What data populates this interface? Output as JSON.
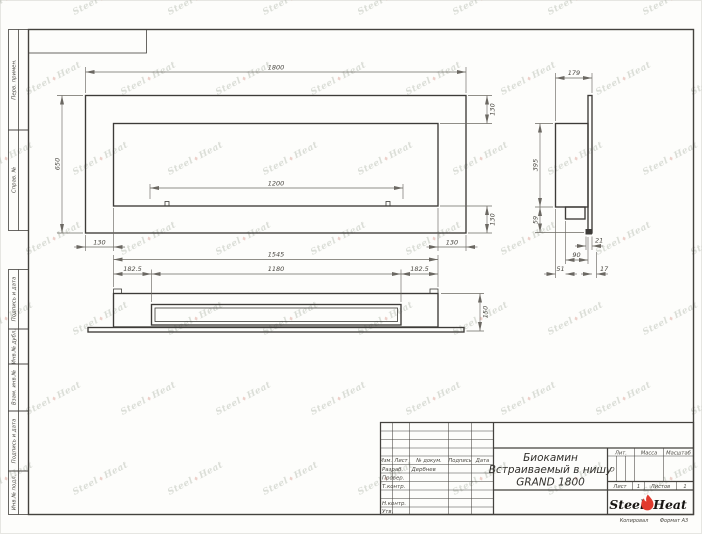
{
  "watermark": {
    "left": "Steel",
    "right": "Heat",
    "flame": "♦"
  },
  "margin_labels": [
    "Перв. примен.",
    "Справ. №",
    "Подпись и дата",
    "Инв.№ дубл.",
    "Взам. инв.№",
    "Подпись и дата",
    "Инв.№ подл."
  ],
  "views": {
    "front": {
      "width": "1800",
      "height": "650",
      "burner": "1200",
      "top_right": "130",
      "bottom_right": "130",
      "bottom_left": "130",
      "bottom_right2": "130"
    },
    "plan": {
      "width": "1545",
      "left": "182.5",
      "slot": "1180",
      "right": "182.5",
      "depth": "150"
    },
    "side": {
      "depth": "179",
      "height": "395",
      "bottom": "59",
      "lip": "21",
      "box": "90",
      "inset": "51",
      "gap": "17"
    }
  },
  "title_block": {
    "cols": {
      "izm": "Изм.",
      "list": "Лист",
      "doc": "№ докум.",
      "sign": "Подпись",
      "date": "Дата"
    },
    "rows": [
      {
        "label": "Разраб.",
        "value": "Дербнев"
      },
      {
        "label": "Провер.",
        "value": ""
      },
      {
        "label": "Т.контр.",
        "value": ""
      },
      {
        "label": "Н.контр.",
        "value": ""
      },
      {
        "label": "Утв.",
        "value": ""
      }
    ],
    "title": {
      "line1": "Биокамин",
      "line2": "Встраиваемый в нишу",
      "line3": "GRAND 1800"
    },
    "lit": {
      "label": "Лит.",
      "value": "О"
    },
    "mass": {
      "label": "Масса",
      "value": ""
    },
    "scale": {
      "label": "Масштаб",
      "value": ""
    },
    "sheet": {
      "label": "Лист",
      "value": "1"
    },
    "sheets": {
      "label": "Листов",
      "value": "1"
    },
    "logo": {
      "left": "Steel",
      "right": "Heat"
    },
    "footer": {
      "copy": "Копировал",
      "format": "Формат А3"
    }
  }
}
